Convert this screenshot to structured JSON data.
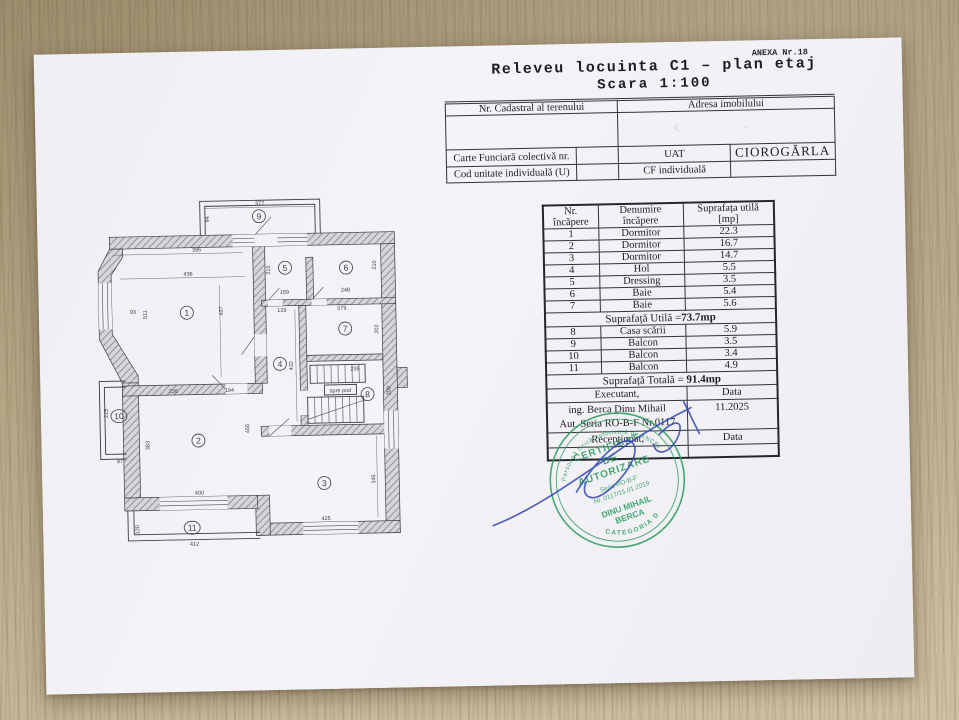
{
  "page": {
    "anexa": "ANEXA Nr.18",
    "title": "Releveu locuinta C1 – plan etaj",
    "subtitle": "Scara 1:100"
  },
  "info_table": {
    "cadastral_label": "Nr. Cadastral al terenului",
    "address_label": "Adresa imobilului",
    "address_faint": "C –",
    "carte_label": "Carte Funciară colectivă nr.",
    "uat_label": "UAT",
    "uat_value": "CIOROGĂRLA",
    "cod_label": "Cod unitate individuală (U)",
    "cf_label": "CF individuală"
  },
  "rooms_table": {
    "header": {
      "col1a": "Nr.",
      "col1b": "încăpere",
      "col2a": "Denumire",
      "col2b": "încăpere",
      "col3a": "Suprafața utilă",
      "col3b": "[mp]"
    },
    "rows": [
      {
        "nr": "1",
        "name": "Dormitor",
        "area": "22.3"
      },
      {
        "nr": "2",
        "name": "Dormitor",
        "area": "16.7"
      },
      {
        "nr": "3",
        "name": "Dormitor",
        "area": "14.7"
      },
      {
        "nr": "4",
        "name": "Hol",
        "area": "5.5"
      },
      {
        "nr": "5",
        "name": "Dressing",
        "area": "3.5"
      },
      {
        "nr": "6",
        "name": "Baie",
        "area": "5.4"
      },
      {
        "nr": "7",
        "name": "Baie",
        "area": "5.6"
      }
    ],
    "subtotal_label": "Suprafață Utilă =",
    "subtotal_value": "73.7mp",
    "rows2": [
      {
        "nr": "8",
        "name": "Casa scării",
        "area": "5.9"
      },
      {
        "nr": "9",
        "name": "Balcon",
        "area": "3.5"
      },
      {
        "nr": "10",
        "name": "Balcon",
        "area": "3.4"
      },
      {
        "nr": "11",
        "name": "Balcon",
        "area": "4.9"
      }
    ],
    "total_label": "Suprafață Totală = ",
    "total_value": "91.4mp",
    "executant_label": "Executant,",
    "data_label": "Data",
    "executant_line1": "ing. Berca Dinu Mihail",
    "executant_line2": "Aut. Seria RO-B-F Nr.0117",
    "data_value": "11.2025",
    "receptionat_label": "Recepţionat,",
    "data_label2": "Data"
  },
  "stamp": {
    "l1": "CERTIFICAT",
    "l2": "DE",
    "l3": "AUTORIZARE",
    "l4": "Seria RO-B-F",
    "l5": "Nr. 0117/15.01.2019",
    "l6": "DINU MIHAIL",
    "l7": "BERCA",
    "arc_top": "Persoană fizică autorizată de ANCPI",
    "arc_bottom": "CATEGORIA D",
    "color": "#2f9e5f"
  },
  "plan": {
    "room_labels": [
      "1",
      "2",
      "3",
      "4",
      "5",
      "6",
      "7",
      "8",
      "9",
      "10",
      "11"
    ],
    "dims": [
      "377",
      "94",
      "395",
      "436",
      "437",
      "93",
      "511",
      "210",
      "159",
      "248",
      "210",
      "129",
      "279",
      "202",
      "432",
      "235",
      "208",
      "226",
      "194",
      "455",
      "383",
      "400",
      "425",
      "345",
      "412",
      "120",
      "215",
      "97"
    ],
    "stair_label": "spre pod"
  }
}
